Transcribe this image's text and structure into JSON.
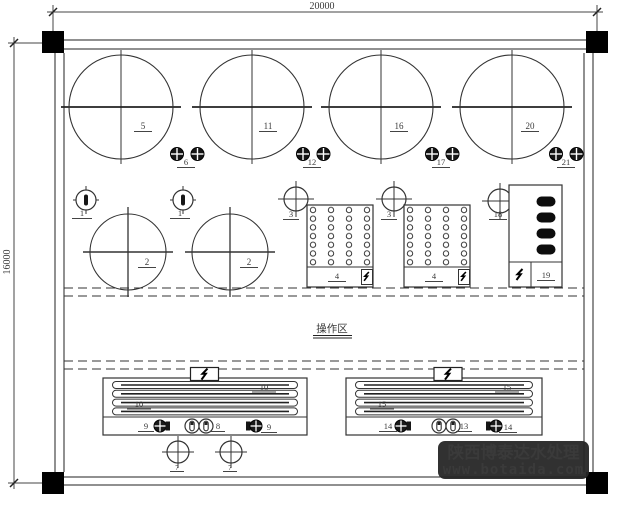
{
  "drawing": {
    "dimension_top_label": "20000",
    "dimension_left_label": "16000",
    "operation_area_label": "操作区",
    "equipment_numbers": {
      "n1": "1",
      "n2": "2",
      "n3": "3",
      "n4": "4",
      "n5": "5",
      "n6": "6",
      "n7": "7",
      "n8": "8",
      "n9": "9",
      "n10": "10",
      "n11": "11",
      "n12": "12",
      "n13": "13",
      "n14": "14",
      "n15": "15",
      "n16": "16",
      "n17": "17",
      "n18": "18",
      "n19": "19",
      "n20": "20",
      "n21": "21"
    },
    "icons": {
      "lightning": "lightning-bolt-icon",
      "column_marker": "filled-square-column-marker"
    }
  },
  "watermark": {
    "company_name": "陕西博泰达水处理",
    "website_url": "www.botaida.com",
    "background_color": "#262626",
    "company_text_color": "#f5f5f5",
    "website_text_color": "#2FB9CF"
  },
  "colors": {
    "paper": "#ffffff",
    "line": "#333333",
    "marker_fill": "#000000"
  }
}
